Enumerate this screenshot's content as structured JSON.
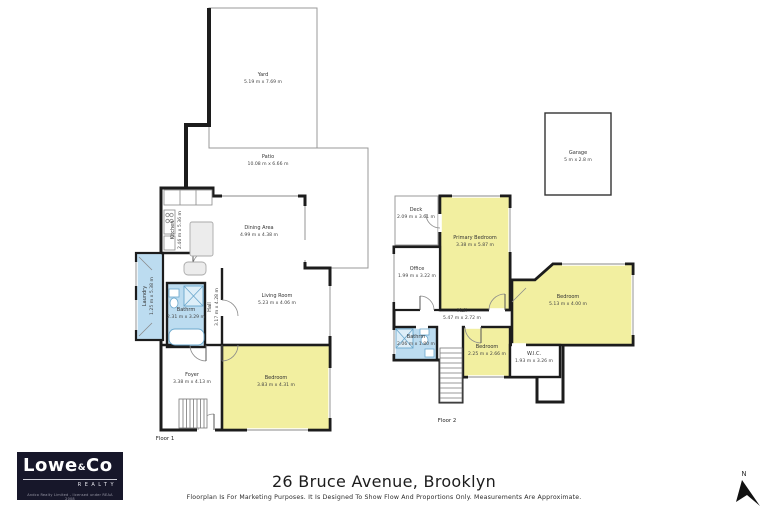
{
  "footer": {
    "address": "26 Bruce Avenue, Brooklyn",
    "disclaimer": "Floorplan Is For Marketing Purposes. It Is Designed To Show Flow And Proportions Only. Measurements Are Approximate."
  },
  "logo": {
    "brand_lowe": "Lowe",
    "brand_amp": "&",
    "brand_co": "Co",
    "realty": "REALTY",
    "fine": "Andco Realty Limited - licensed under REAA 2008"
  },
  "compass": {
    "north_label": "N"
  },
  "garage": {
    "name": "Garage",
    "dims": "5 m x 2.8 m"
  },
  "colors": {
    "room_yellow": "#f2efa0",
    "room_blue": "#bcdcf0",
    "wall_black": "#1c1c1c",
    "outline_gray": "#999999",
    "logo_bg": "#17172a"
  },
  "floors": {
    "floor1": {
      "label": "Floor 1",
      "rooms": {
        "yard": {
          "name": "Yard",
          "dims": "5.19 m x 7.69 m"
        },
        "patio": {
          "name": "Patio",
          "dims": "10.08 m x 6.66 m"
        },
        "kitchen": {
          "name": "Kitchen",
          "dims": "2.46 m x 5.36 m"
        },
        "dining": {
          "name": "Dining Area",
          "dims": "4.99 m x 4.38 m"
        },
        "laundry": {
          "name": "Laundry",
          "dims": "1.25 m x 5.38 m"
        },
        "bathroom": {
          "name": "Bathrm",
          "dims": "2.31 m x 3.29 m"
        },
        "hall": {
          "name": "Hall",
          "dims": "3.17 m x 4.28 m"
        },
        "living": {
          "name": "Living Room",
          "dims": "5.23 m x 4.06 m"
        },
        "foyer": {
          "name": "Foyer",
          "dims": "3.38 m x 4.13 m"
        },
        "bedroom": {
          "name": "Bedroom",
          "dims": "3.83 m x 4.31 m"
        }
      }
    },
    "floor2": {
      "label": "Floor 2",
      "rooms": {
        "deck": {
          "name": "Deck",
          "dims": "2.09 m x 3.61 m"
        },
        "primary": {
          "name": "Primary Bedroom",
          "dims": "3.38 m x 5.87 m"
        },
        "office": {
          "name": "Office",
          "dims": "1.99 m x 3.22 m"
        },
        "hall": {
          "name": "Hall",
          "dims": "5.47 m x 2.72 m"
        },
        "bathroom": {
          "name": "Bathrm",
          "dims": "2.06 m x 1.80 m"
        },
        "bedroom_right": {
          "name": "Bedroom",
          "dims": "5.13 m x 4.00 m"
        },
        "bedroom_small": {
          "name": "Bedroom",
          "dims": "2.25 m x 2.66 m"
        },
        "wic": {
          "name": "W.I.C.",
          "dims": "1.93 m x 3.26 m"
        }
      }
    }
  }
}
